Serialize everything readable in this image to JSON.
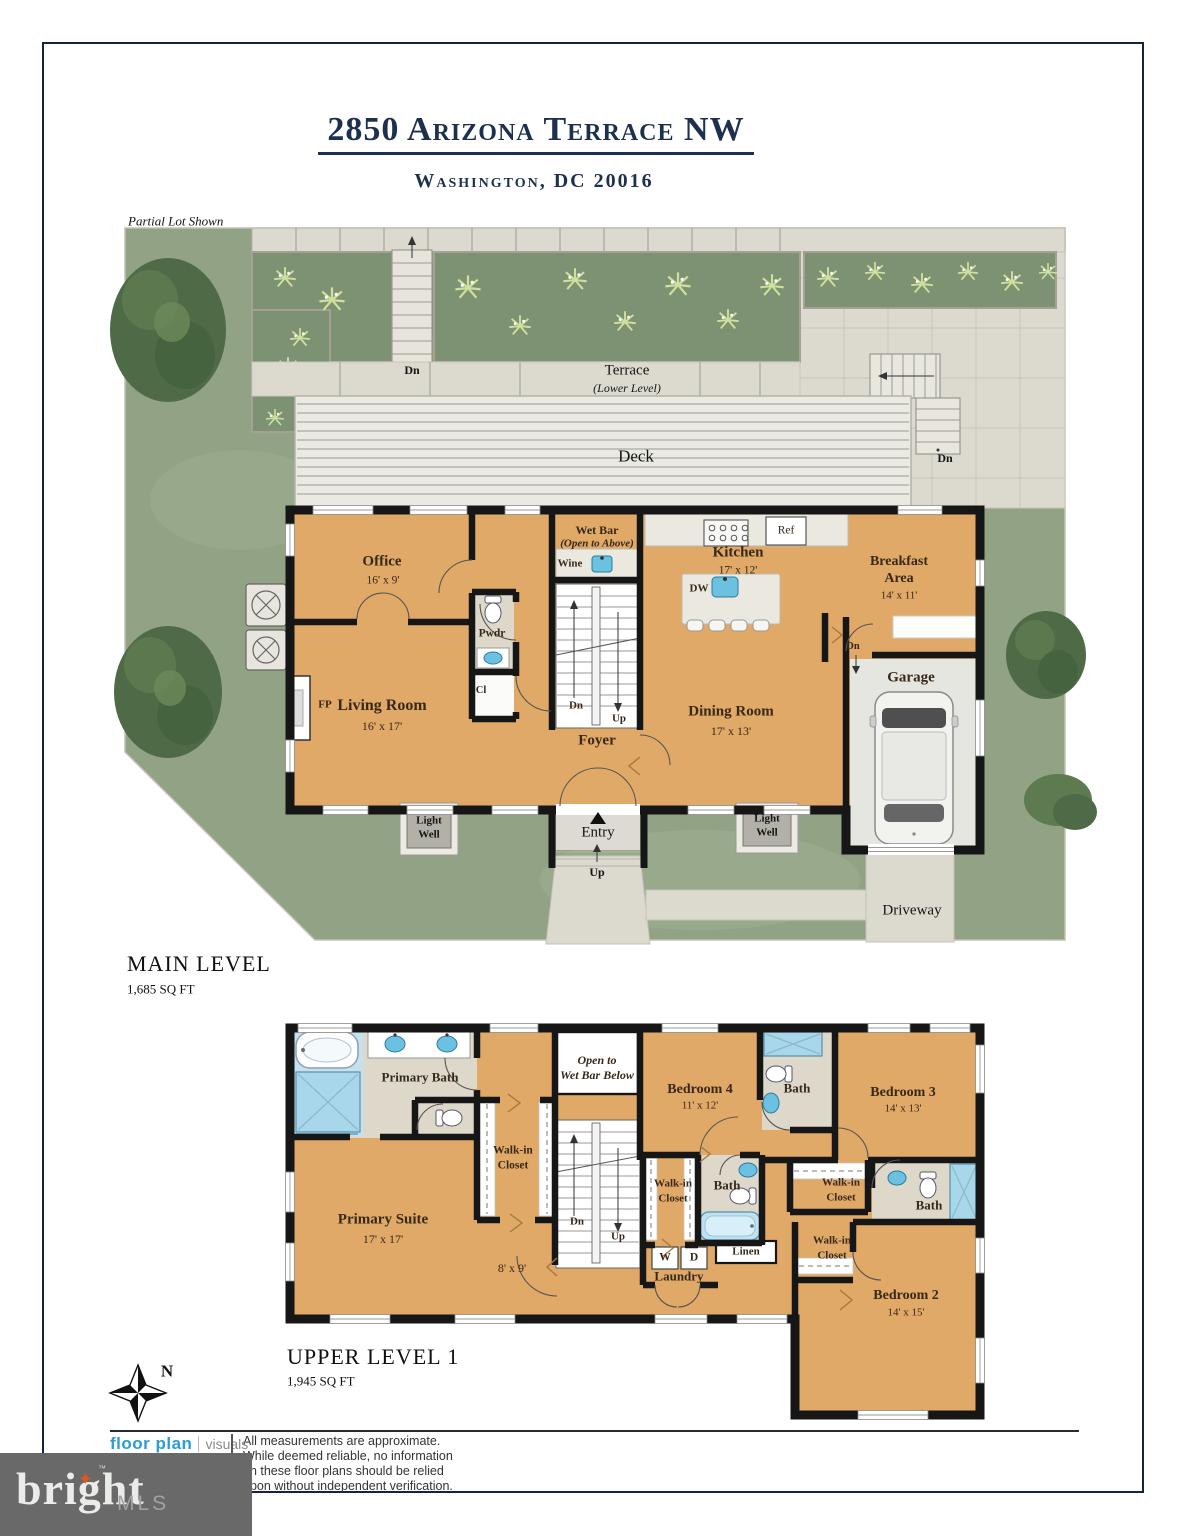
{
  "title": {
    "address": "2850 Arizona Terrace NW",
    "city": "Washington, DC 20016"
  },
  "site": {
    "note": "Partial Lot Shown",
    "terrace": "Terrace",
    "terrace_sub": "(Lower Level)",
    "deck": "Deck",
    "entry": "Entry",
    "driveway": "Driveway",
    "north": "N"
  },
  "labels": {
    "dn": "Dn",
    "up": "Up",
    "bath": "Bath",
    "walk_in": "Walk-in",
    "closet": "Closet",
    "light": "Light",
    "well": "Well"
  },
  "main_level": {
    "heading": "MAIN LEVEL",
    "area": "1,685 SQ FT",
    "office": "Office",
    "office_dims": "16' x 9'",
    "living_room": "Living Room",
    "living_dims": "16' x 17'",
    "fireplace": "FP",
    "powder": "Pwdr",
    "closet": "Cl",
    "wet_bar": "Wet Bar",
    "wet_bar_note": "(Open to Above)",
    "wine": "Wine",
    "foyer": "Foyer",
    "kitchen": "Kitchen",
    "kitchen_dims": "17' x 12'",
    "dishwasher": "DW",
    "fridge": "Ref",
    "breakfast1": "Breakfast",
    "breakfast2": "Area",
    "breakfast_dims": "14' x 11'",
    "dining": "Dining Room",
    "dining_dims": "17' x 13'",
    "garage": "Garage"
  },
  "upper_level": {
    "heading": "UPPER LEVEL 1",
    "area": "1,945 SQ FT",
    "primary_bath": "Primary Bath",
    "primary_suite": "Primary Suite",
    "suite_dims": "17' x 17'",
    "open_to1": "Open to",
    "open_to2": "Wet Bar Below",
    "bedroom4": "Bedroom 4",
    "bedroom4_dims": "11' x 12'",
    "bedroom3": "Bedroom 3",
    "bedroom3_dims": "14' x 13'",
    "bedroom2": "Bedroom 2",
    "bedroom2_dims": "14' x 15'",
    "hall_dims": "8' x 9'",
    "linen": "Linen",
    "laundry": "Laundry",
    "washer": "W",
    "dryer": "D"
  },
  "footer": {
    "logo_primary": "floor plan",
    "logo_secondary": "visuals",
    "disclaimer": [
      "All measurements are approximate.",
      "While deemed reliable, no information",
      "on these floor plans should be relied",
      "upon without independent verification."
    ]
  },
  "brand": {
    "name": "bright",
    "tm": "™",
    "suffix": "MLS"
  },
  "icons": {
    "brand_star": "✦"
  },
  "colors": {
    "navy": "#1e3050",
    "floor_tan": "#e0a967",
    "wall": "#161616",
    "grass": "#92a284",
    "planting_bed": "#7c9272",
    "deck": "#eaeae3",
    "paver": "#dcd9cf",
    "fixture_blue": "#6cc0e0",
    "bath_tile": "#ddd8c9",
    "logo_blue": "#2b9cd8",
    "brand_bg": "#696969",
    "brand_star": "#e0571f"
  }
}
